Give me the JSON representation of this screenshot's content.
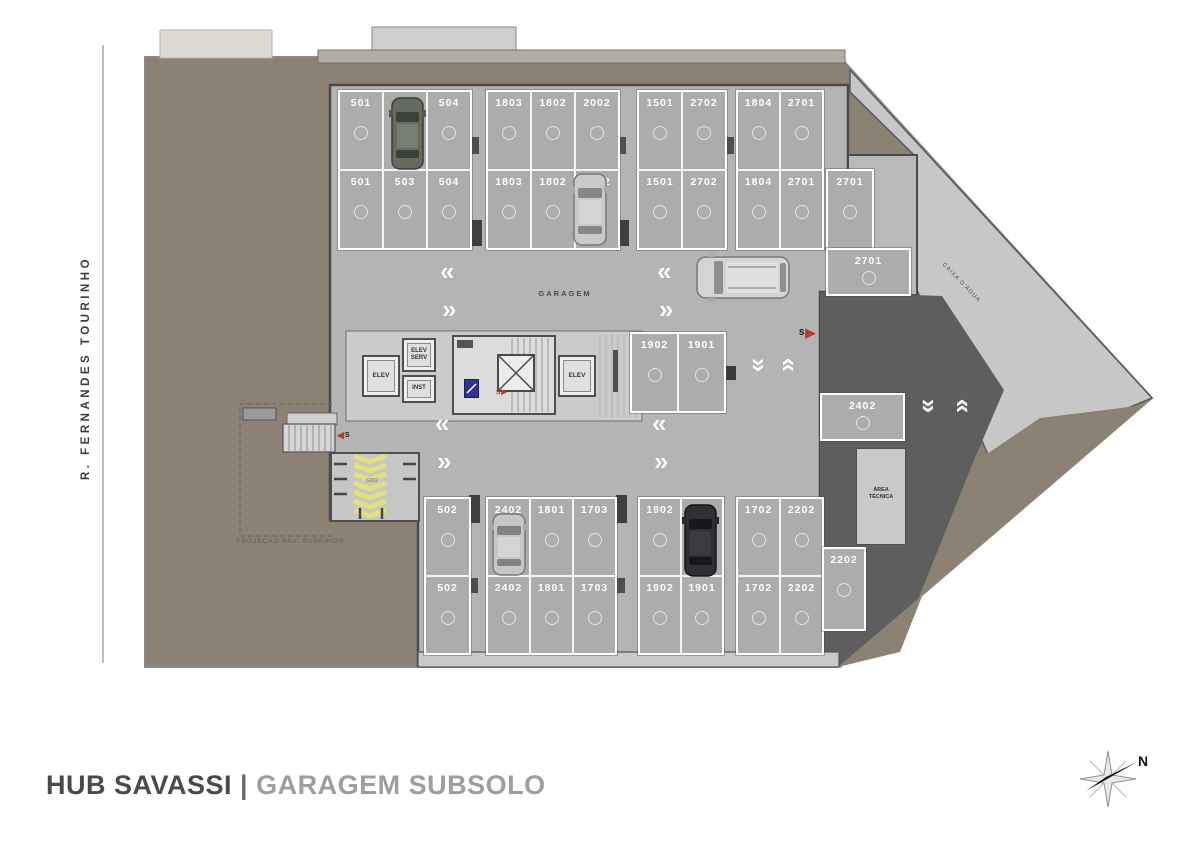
{
  "title": {
    "project": "HUB SAVASSI",
    "separator": "|",
    "subtitle": "GARAGEM SUBSOLO"
  },
  "street": {
    "name": "R. FERNANDES TOURINHO"
  },
  "compass": {
    "north_label": "N"
  },
  "labels": {
    "garage": "GARAGEM",
    "water_tank": "CAIXA D'ÁGUA",
    "technical_area_line1": "ÁREA",
    "technical_area_line2": "TÉCNICA",
    "projection": "PROJEÇÃO PAV. SUPERIOR",
    "bike_area": "GM2",
    "elevator_left": "ELEV",
    "elevator_right": "ELEV",
    "service_elevator_line1": "ELEV",
    "service_elevator_line2": "SERV",
    "inst": "INST",
    "entry_marker": "S",
    "stair_marker": "S",
    "core_stair_marker": "S"
  },
  "icons": {
    "arrow_right": "▶",
    "arrow_left": "◀",
    "chevron_left": "«",
    "chevron_right": "»",
    "compass": "compass-rose",
    "car": "car-top-view"
  },
  "colors": {
    "terrain": "#8B8274",
    "garage_floor": "#B4B4B4",
    "parking_space": "#ACACAC",
    "ramp_dark": "#5E5E5E",
    "light_area": "#C7C7C7",
    "core_area": "#CBCBCB",
    "accent_red": "#C0392B",
    "marking_yellow": "#E6E06E",
    "white_line": "#FFFFFF",
    "title_dark": "#4A4A4A",
    "title_light": "#9E9E9E"
  },
  "parking": {
    "groups": [
      {
        "name": "top-left",
        "x": 338,
        "y": 90,
        "cw": 42,
        "rh": 77,
        "rows": [
          [
            "501",
            "503",
            "504"
          ],
          [
            "501",
            "503",
            "504"
          ]
        ]
      },
      {
        "name": "top-mid",
        "x": 486,
        "y": 90,
        "cw": 42,
        "rh": 77,
        "rows": [
          [
            "1803",
            "1802",
            "2002"
          ],
          [
            "1803",
            "1802",
            "2002"
          ]
        ]
      },
      {
        "name": "top-right-a",
        "x": 637,
        "y": 90,
        "cw": 42,
        "rh": 77,
        "rows": [
          [
            "1501",
            "2702"
          ],
          [
            "1501",
            "2702"
          ]
        ]
      },
      {
        "name": "top-right-b",
        "x": 736,
        "y": 90,
        "cw": 41,
        "rh": 77,
        "rows": [
          [
            "1804",
            "2701"
          ],
          [
            "1804",
            "2701"
          ]
        ]
      },
      {
        "name": "right-2701-v",
        "x": 826,
        "y": 169,
        "cw": 44,
        "rh": 77,
        "rows": [
          [
            "2701"
          ]
        ]
      },
      {
        "name": "right-2701-h",
        "x": 826,
        "y": 248,
        "cw": 81,
        "rh": 44,
        "rows": [
          [
            "2701"
          ]
        ],
        "horizontal": true
      },
      {
        "name": "mid-pair",
        "x": 630,
        "y": 332,
        "cw": 45,
        "rh": 77,
        "rows": [
          [
            "1902",
            "1901"
          ]
        ]
      },
      {
        "name": "right-2402-h",
        "x": 820,
        "y": 393,
        "cw": 81,
        "rh": 44,
        "rows": [
          [
            "2402"
          ]
        ],
        "horizontal": true
      },
      {
        "name": "bottom-502",
        "x": 424,
        "y": 497,
        "cw": 43,
        "rh": 76,
        "rows": [
          [
            "502"
          ],
          [
            "502"
          ]
        ]
      },
      {
        "name": "bottom-mid",
        "x": 486,
        "y": 497,
        "cw": 41,
        "rh": 76,
        "rows": [
          [
            "2402",
            "1801",
            "1703"
          ],
          [
            "2402",
            "1801",
            "1703"
          ]
        ]
      },
      {
        "name": "bottom-pair",
        "x": 638,
        "y": 497,
        "cw": 40,
        "rh": 76,
        "rows": [
          [
            "1902",
            "1901"
          ],
          [
            "1902",
            "1901"
          ]
        ]
      },
      {
        "name": "bottom-right",
        "x": 736,
        "y": 497,
        "cw": 41,
        "rh": 76,
        "rows": [
          [
            "1702",
            "2202"
          ],
          [
            "1702",
            "2202"
          ]
        ]
      },
      {
        "name": "right-2202",
        "x": 822,
        "y": 547,
        "cw": 40,
        "rh": 80,
        "rows": [
          [
            "2202"
          ]
        ]
      }
    ]
  },
  "chevrons": [
    {
      "x": 440,
      "y": 258,
      "g": "«",
      "rot": 0
    },
    {
      "x": 442,
      "y": 296,
      "g": "»",
      "rot": 0
    },
    {
      "x": 657,
      "y": 258,
      "g": "«",
      "rot": 0
    },
    {
      "x": 659,
      "y": 296,
      "g": "»",
      "rot": 0
    },
    {
      "x": 435,
      "y": 410,
      "g": "«",
      "rot": 0
    },
    {
      "x": 437,
      "y": 448,
      "g": "»",
      "rot": 0
    },
    {
      "x": 652,
      "y": 410,
      "g": "«",
      "rot": 0
    },
    {
      "x": 654,
      "y": 448,
      "g": "»",
      "rot": 0
    },
    {
      "x": 749,
      "y": 352,
      "g": "«",
      "rot": -90
    },
    {
      "x": 783,
      "y": 352,
      "g": "«",
      "rot": 90
    },
    {
      "x": 919,
      "y": 393,
      "g": "«",
      "rot": -90
    },
    {
      "x": 957,
      "y": 393,
      "g": "«",
      "rot": 90
    }
  ]
}
